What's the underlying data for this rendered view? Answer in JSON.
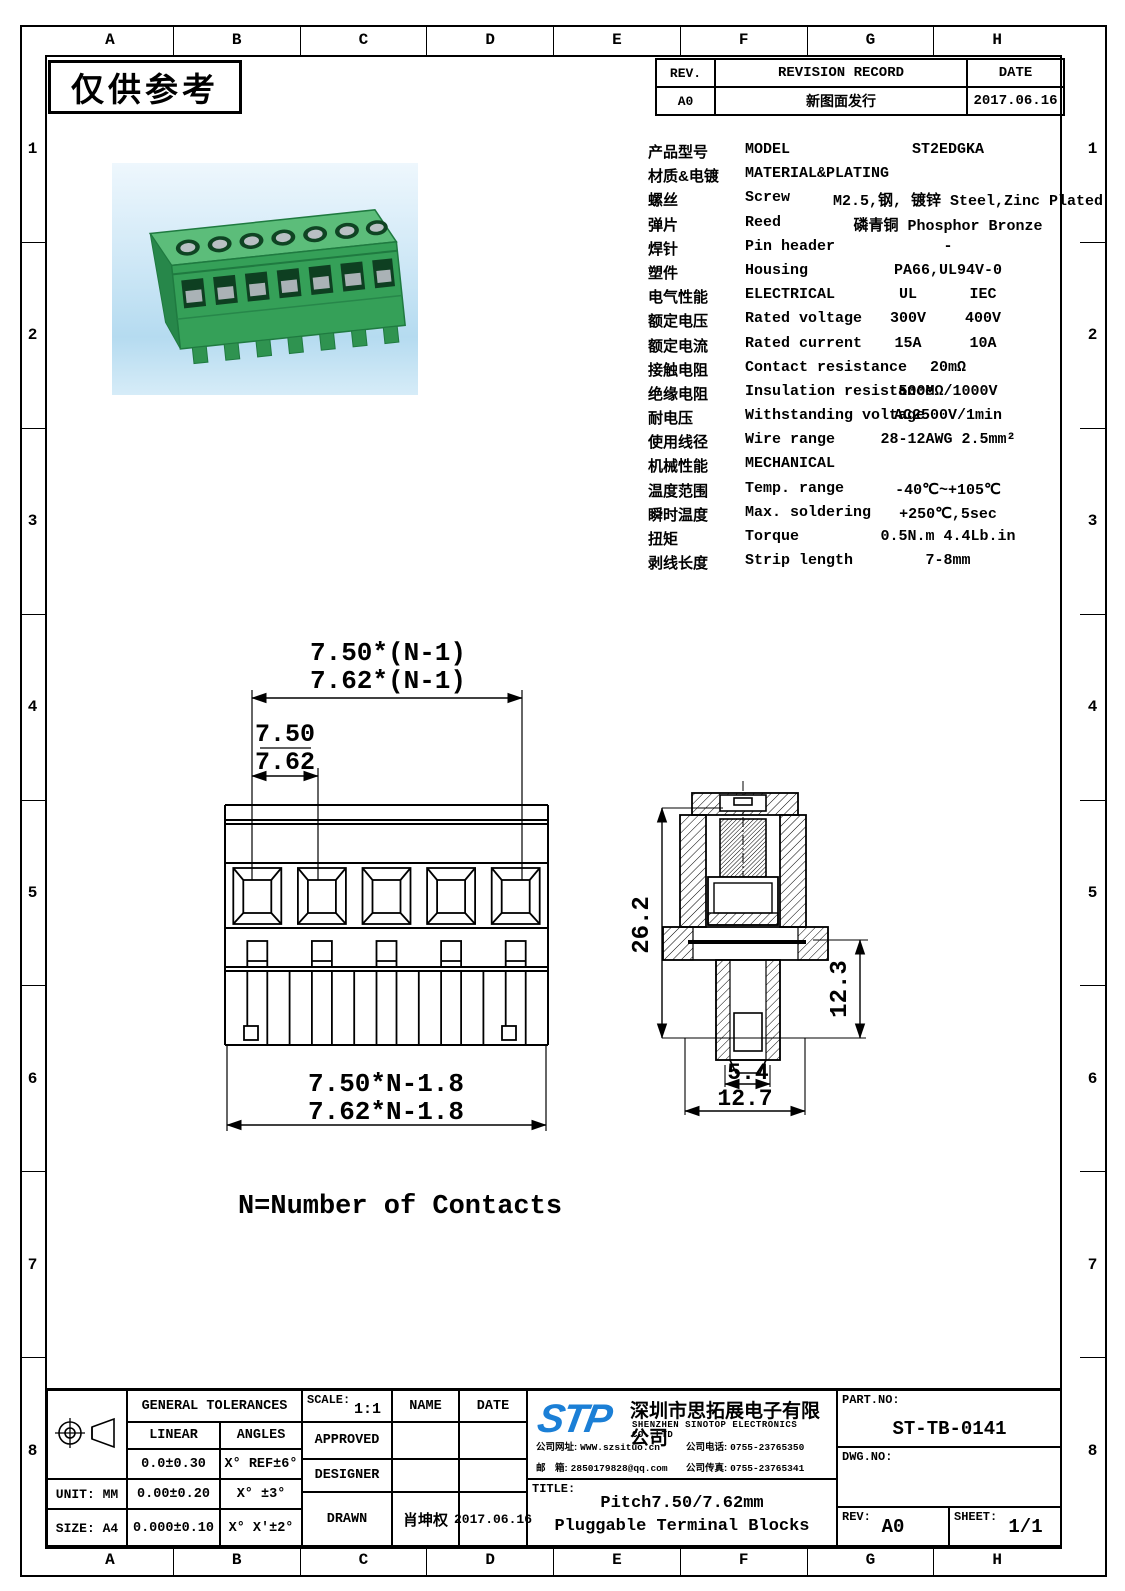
{
  "frame": {
    "zone_cols": [
      "A",
      "B",
      "C",
      "D",
      "E",
      "F",
      "G",
      "H"
    ],
    "zone_rows": [
      "1",
      "2",
      "3",
      "4",
      "5",
      "6",
      "7",
      "8"
    ],
    "watermark": "仅供参考"
  },
  "colors": {
    "logo_blue": "#1b7fd6",
    "photo_bg": "#cde7f6",
    "block_green": "#35a058",
    "block_green_top": "#5cbd7a",
    "block_green_dark": "#1f7a40"
  },
  "revision": {
    "col_rev": "REV.",
    "col_record": "REVISION RECORD",
    "col_date": "DATE",
    "row_rev": "A0",
    "row_record": "新图面发行",
    "row_date": "2017.06.16"
  },
  "specs": {
    "rows": [
      {
        "cn": "产品型号",
        "en": "MODEL",
        "v": "ST2EDGKA"
      },
      {
        "cn": "材质&电镀",
        "en": "MATERIAL&PLATING",
        "v": ""
      },
      {
        "cn": "螺丝",
        "en": "Screw",
        "v": "M2.5,钢, 镀锌 Steel,Zinc Plated"
      },
      {
        "cn": "弹片",
        "en": "Reed",
        "v": "磷青铜 Phosphor Bronze"
      },
      {
        "cn": "焊针",
        "en": "Pin header",
        "v": "-"
      },
      {
        "cn": "塑件",
        "en": "Housing",
        "v": "PA66,UL94V-0"
      },
      {
        "cn": "电气性能",
        "en": "ELECTRICAL",
        "v1": "UL",
        "v2": "IEC"
      },
      {
        "cn": "额定电压",
        "en": "Rated voltage",
        "v1": "300V",
        "v2": "400V"
      },
      {
        "cn": "额定电流",
        "en": "Rated current",
        "v1": "15A",
        "v2": "10A"
      },
      {
        "cn": "接触电阻",
        "en": "Contact resistance",
        "v": "20mΩ"
      },
      {
        "cn": "绝缘电阻",
        "en": "Insulation resistance",
        "v": "500MΩ/1000V"
      },
      {
        "cn": "耐电压",
        "en": "Withstanding voltage",
        "v": "AC2500V/1min"
      },
      {
        "cn": "使用线径",
        "en": "Wire range",
        "v": "28-12AWG 2.5mm²"
      },
      {
        "cn": "机械性能",
        "en": "MECHANICAL",
        "v": ""
      },
      {
        "cn": "温度范围",
        "en": "Temp. range",
        "v": "-40℃~+105℃"
      },
      {
        "cn": "瞬时温度",
        "en": "Max. soldering",
        "v": "+250℃,5sec"
      },
      {
        "cn": "扭矩",
        "en": "Torque",
        "v": "0.5N.m 4.4Lb.in"
      },
      {
        "cn": "剥线长度",
        "en": "Strip length",
        "v": "7-8mm"
      }
    ]
  },
  "front_view": {
    "dim_span1": "7.50*(N-1)",
    "dim_span2": "7.62*(N-1)",
    "dim_pitch1": "7.50",
    "dim_pitch2": "7.62",
    "dim_total1": "7.50*N-1.8",
    "dim_total2": "7.62*N-1.8"
  },
  "side_view": {
    "dim_height": "26.2",
    "dim_lower": "12.3",
    "dim_slot": "5.4",
    "dim_width": "12.7"
  },
  "note": "N=Number of Contacts",
  "title_block": {
    "tolerances": {
      "title": "GENERAL TOLERANCES",
      "col_linear": "LINEAR",
      "col_angles": "ANGLES",
      "rows": [
        [
          "0.0±0.30",
          "X° REF±6°"
        ],
        [
          "0.00±0.20",
          "X° ±3°"
        ],
        [
          "0.000±0.10",
          "X° X'±2°"
        ]
      ]
    },
    "unit_label": "UNIT: MM",
    "size_label": "SIZE: A4",
    "scale_label": "SCALE:",
    "scale_value": "1:1",
    "col_name": "NAME",
    "col_date": "DATE",
    "row_approved": "APPROVED",
    "row_designer": "DESIGNER",
    "row_drawn": "DRAWN",
    "drawn_name": "肖坤权",
    "drawn_date": "2017.06.16",
    "company": {
      "logo": "STP",
      "name_cn": "深圳市思拓展电子有限公司",
      "name_en": "SHENZHEN SINOTOP ELECTRONICS CO.,LTD",
      "contacts": [
        {
          "label": "公司网址:",
          "value": "WWW.szsituo.cn"
        },
        {
          "label": "公司电话:",
          "value": "0755-23765350"
        },
        {
          "label": "邮　箱:",
          "value": "2850179828@qq.com"
        },
        {
          "label": "公司传真:",
          "value": "0755-23765341"
        }
      ]
    },
    "title_label": "TITLE:",
    "title_line1": "Pitch7.50/7.62mm",
    "title_line2": "Pluggable Terminal Blocks",
    "part_no_label": "PART.NO:",
    "part_no": "ST-TB-0141",
    "dwg_no_label": "DWG.NO:",
    "rev_label": "REV:",
    "rev_value": "A0",
    "sheet_label": "SHEET:",
    "sheet_value": "1/1"
  }
}
